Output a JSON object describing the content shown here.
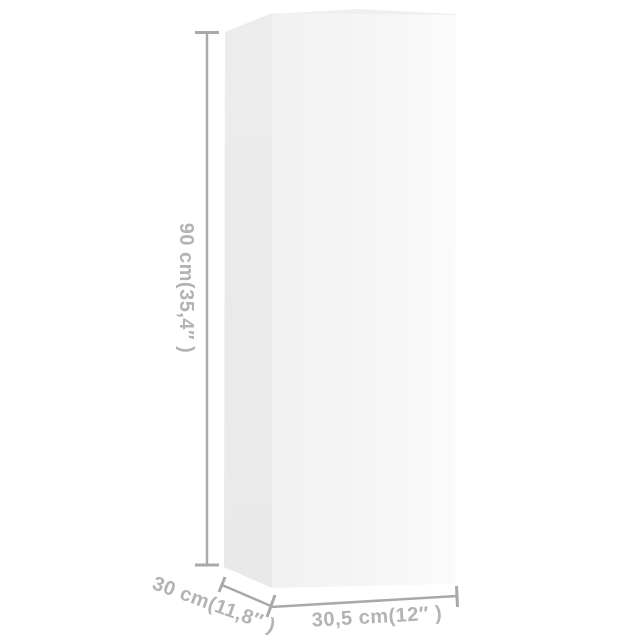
{
  "page": {
    "type": "product-dimension-diagram",
    "background": "#ffffff"
  },
  "product": {
    "name": "tall-rectangular-cabinet-box"
  },
  "dimensions": {
    "height": {
      "label": "90 cm(35,4″ )"
    },
    "depth": {
      "label": "30 cm(11,8″ )"
    },
    "width": {
      "label": "30,5 cm(12″ )"
    }
  },
  "colors": {
    "background": "#ffffff",
    "dimension_line": "#a9a9a9",
    "dimension_text": "#b3b3b3",
    "box_side_face": "#e9e9e9",
    "box_front_face_left": "#f1f1f1",
    "box_front_face_right": "#fbfbfb",
    "box_top_sliver": "#efefef"
  }
}
